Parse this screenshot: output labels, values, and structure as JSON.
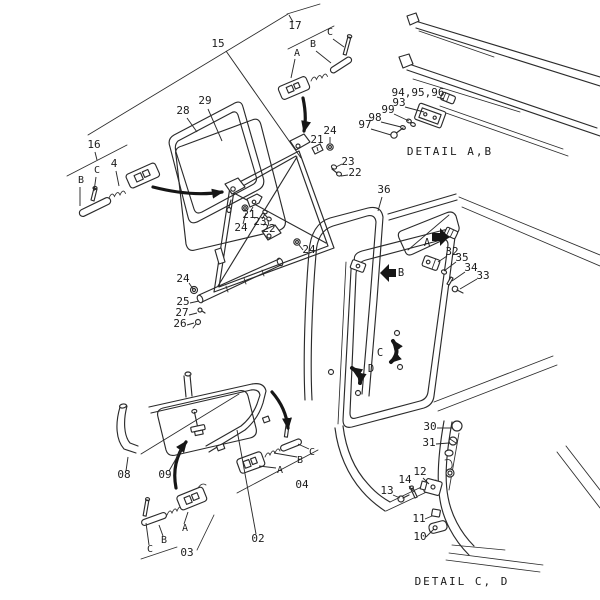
{
  "diagram": {
    "type": "exploded-parts-diagram",
    "background_color": "#ffffff",
    "line_color": "#2b2b2b",
    "text_color": "#1b1b1b",
    "captions": [
      "DETAIL A,B",
      "DETAIL C, D"
    ],
    "labels": [
      {
        "t": "15",
        "k": "num",
        "x": 218,
        "y": 47,
        "l": [
          226,
          51,
          301,
          158
        ]
      },
      {
        "t": "17",
        "k": "num",
        "x": 295,
        "y": 29,
        "l": [
          293,
          22,
          289,
          15
        ]
      },
      {
        "t": "A",
        "k": "ref",
        "x": 297,
        "y": 56,
        "l": [
          295,
          59,
          291,
          78
        ]
      },
      {
        "t": "B",
        "k": "ref",
        "x": 313,
        "y": 47,
        "l": [
          316,
          51,
          331,
          63
        ]
      },
      {
        "t": "C",
        "k": "ref",
        "x": 330,
        "y": 35,
        "l": [
          333,
          39,
          344,
          47
        ]
      },
      {
        "t": "16",
        "k": "num",
        "x": 94,
        "y": 148,
        "l": [
          95,
          152,
          97,
          160
        ]
      },
      {
        "t": "B",
        "k": "ref",
        "x": 81,
        "y": 183,
        "l": [
          80,
          187,
          80,
          206
        ]
      },
      {
        "t": "C",
        "k": "ref",
        "x": 97,
        "y": 173,
        "l": [
          96,
          177,
          94,
          191
        ]
      },
      {
        "t": "4",
        "k": "num",
        "x": 114,
        "y": 167,
        "l": [
          116,
          171,
          119,
          186
        ]
      },
      {
        "t": "28",
        "k": "num",
        "x": 183,
        "y": 114,
        "l": [
          187,
          118,
          197,
          132
        ]
      },
      {
        "t": "29",
        "k": "num",
        "x": 205,
        "y": 104,
        "l": [
          208,
          109,
          222,
          141
        ]
      },
      {
        "t": "24",
        "k": "num",
        "x": 330,
        "y": 134,
        "l": [
          330,
          137,
          330,
          143
        ]
      },
      {
        "t": "21",
        "k": "num",
        "x": 317,
        "y": 143,
        "l": [
          317,
          147,
          318,
          151
        ]
      },
      {
        "t": "23",
        "k": "num",
        "x": 348,
        "y": 165,
        "l": [
          342,
          164,
          336,
          167
        ]
      },
      {
        "t": "22",
        "k": "num",
        "x": 355,
        "y": 176,
        "l": [
          348,
          175,
          341,
          176
        ]
      },
      {
        "t": "21",
        "k": "num",
        "x": 249,
        "y": 218,
        "l": [
          250,
          212,
          253,
          207
        ]
      },
      {
        "t": "23",
        "k": "num",
        "x": 260,
        "y": 225,
        "l": [
          262,
          219,
          265,
          214
        ]
      },
      {
        "t": "22",
        "k": "num",
        "x": 269,
        "y": 232,
        "l": [
          269,
          226,
          268,
          221
        ]
      },
      {
        "t": "24",
        "k": "num",
        "x": 241,
        "y": 231,
        "l": [
          243,
          224,
          246,
          213
        ]
      },
      {
        "t": "24",
        "k": "num",
        "x": 309,
        "y": 253,
        "l": [
          303,
          250,
          299,
          245
        ]
      },
      {
        "t": "24",
        "k": "num",
        "x": 183,
        "y": 282,
        "l": [
          189,
          283,
          193,
          289
        ]
      },
      {
        "t": "25",
        "k": "num",
        "x": 183,
        "y": 305,
        "l": [
          190,
          303,
          199,
          301
        ]
      },
      {
        "t": "27",
        "k": "num",
        "x": 182,
        "y": 316,
        "l": [
          189,
          315,
          197,
          313
        ]
      },
      {
        "t": "26",
        "k": "num",
        "x": 180,
        "y": 327,
        "l": [
          187,
          325,
          194,
          323
        ]
      },
      {
        "t": "94,95,96",
        "k": "num",
        "x": 418,
        "y": 96,
        "l": [
          437,
          97,
          444,
          99
        ]
      },
      {
        "t": "93",
        "k": "num",
        "x": 399,
        "y": 106,
        "l": [
          405,
          107,
          424,
          112
        ]
      },
      {
        "t": "99",
        "k": "num",
        "x": 388,
        "y": 113,
        "l": [
          394,
          114,
          409,
          121
        ]
      },
      {
        "t": "98",
        "k": "num",
        "x": 375,
        "y": 121,
        "l": [
          381,
          122,
          401,
          127
        ]
      },
      {
        "t": "97",
        "k": "num",
        "x": 365,
        "y": 128,
        "l": [
          371,
          129,
          391,
          135
        ]
      },
      {
        "t": "36",
        "k": "num",
        "x": 384,
        "y": 193,
        "l": [
          382,
          197,
          378,
          211
        ]
      },
      {
        "t": "32",
        "k": "num",
        "x": 452,
        "y": 255,
        "l": [
          447,
          256,
          438,
          262
        ]
      },
      {
        "t": "35",
        "k": "num",
        "x": 462,
        "y": 261,
        "l": [
          456,
          262,
          444,
          271
        ]
      },
      {
        "t": "34",
        "k": "num",
        "x": 471,
        "y": 271,
        "l": [
          465,
          272,
          452,
          281
        ]
      },
      {
        "t": "33",
        "k": "num",
        "x": 483,
        "y": 279,
        "l": [
          477,
          279,
          460,
          289
        ]
      },
      {
        "t": "A",
        "k": "view",
        "x": 427,
        "y": 246
      },
      {
        "t": "B",
        "k": "view",
        "x": 401,
        "y": 276
      },
      {
        "t": "C",
        "k": "view",
        "x": 380,
        "y": 356
      },
      {
        "t": "D",
        "k": "view",
        "x": 371,
        "y": 372
      },
      {
        "t": "08",
        "k": "num",
        "x": 124,
        "y": 478,
        "l": [
          126,
          471,
          128,
          457
        ]
      },
      {
        "t": "09",
        "k": "num",
        "x": 165,
        "y": 478,
        "l": [
          169,
          471,
          181,
          450
        ]
      },
      {
        "t": "02",
        "k": "num",
        "x": 258,
        "y": 542,
        "l": [
          256,
          534,
          237,
          430
        ]
      },
      {
        "t": "03",
        "k": "num",
        "x": 187,
        "y": 556
      },
      {
        "t": "A",
        "k": "ref",
        "x": 185,
        "y": 531,
        "l": [
          184,
          524,
          188,
          512
        ]
      },
      {
        "t": "B",
        "k": "ref",
        "x": 164,
        "y": 543,
        "l": [
          163,
          536,
          159,
          525
        ]
      },
      {
        "t": "C",
        "k": "ref",
        "x": 150,
        "y": 552,
        "l": [
          149,
          545,
          146,
          523
        ]
      },
      {
        "t": "04",
        "k": "num",
        "x": 302,
        "y": 488
      },
      {
        "t": "A",
        "k": "ref",
        "x": 280,
        "y": 473,
        "l": [
          276,
          468,
          259,
          466
        ]
      },
      {
        "t": "B",
        "k": "ref",
        "x": 300,
        "y": 463,
        "l": [
          297,
          457,
          274,
          453
        ]
      },
      {
        "t": "C",
        "k": "ref",
        "x": 312,
        "y": 455,
        "l": [
          309,
          449,
          298,
          444
        ]
      },
      {
        "t": "30",
        "k": "num",
        "x": 430,
        "y": 430,
        "l": [
          437,
          428,
          452,
          428
        ]
      },
      {
        "t": "31",
        "k": "num",
        "x": 429,
        "y": 446,
        "l": [
          436,
          444,
          449,
          443
        ]
      },
      {
        "t": "12",
        "k": "num",
        "x": 420,
        "y": 475,
        "l": [
          423,
          478,
          429,
          484
        ]
      },
      {
        "t": "14",
        "k": "num",
        "x": 405,
        "y": 483,
        "l": [
          409,
          486,
          414,
          492
        ]
      },
      {
        "t": "13",
        "k": "num",
        "x": 387,
        "y": 494,
        "l": [
          393,
          495,
          400,
          498
        ]
      },
      {
        "t": "11",
        "k": "num",
        "x": 419,
        "y": 522,
        "l": [
          425,
          519,
          432,
          516
        ]
      },
      {
        "t": "10",
        "k": "num",
        "x": 420,
        "y": 540,
        "l": [
          426,
          537,
          434,
          529
        ]
      },
      {
        "t": "DETAIL A,B",
        "k": "cap",
        "x": 450,
        "y": 155
      },
      {
        "t": "DETAIL C, D",
        "k": "cap",
        "x": 462,
        "y": 585
      }
    ]
  }
}
